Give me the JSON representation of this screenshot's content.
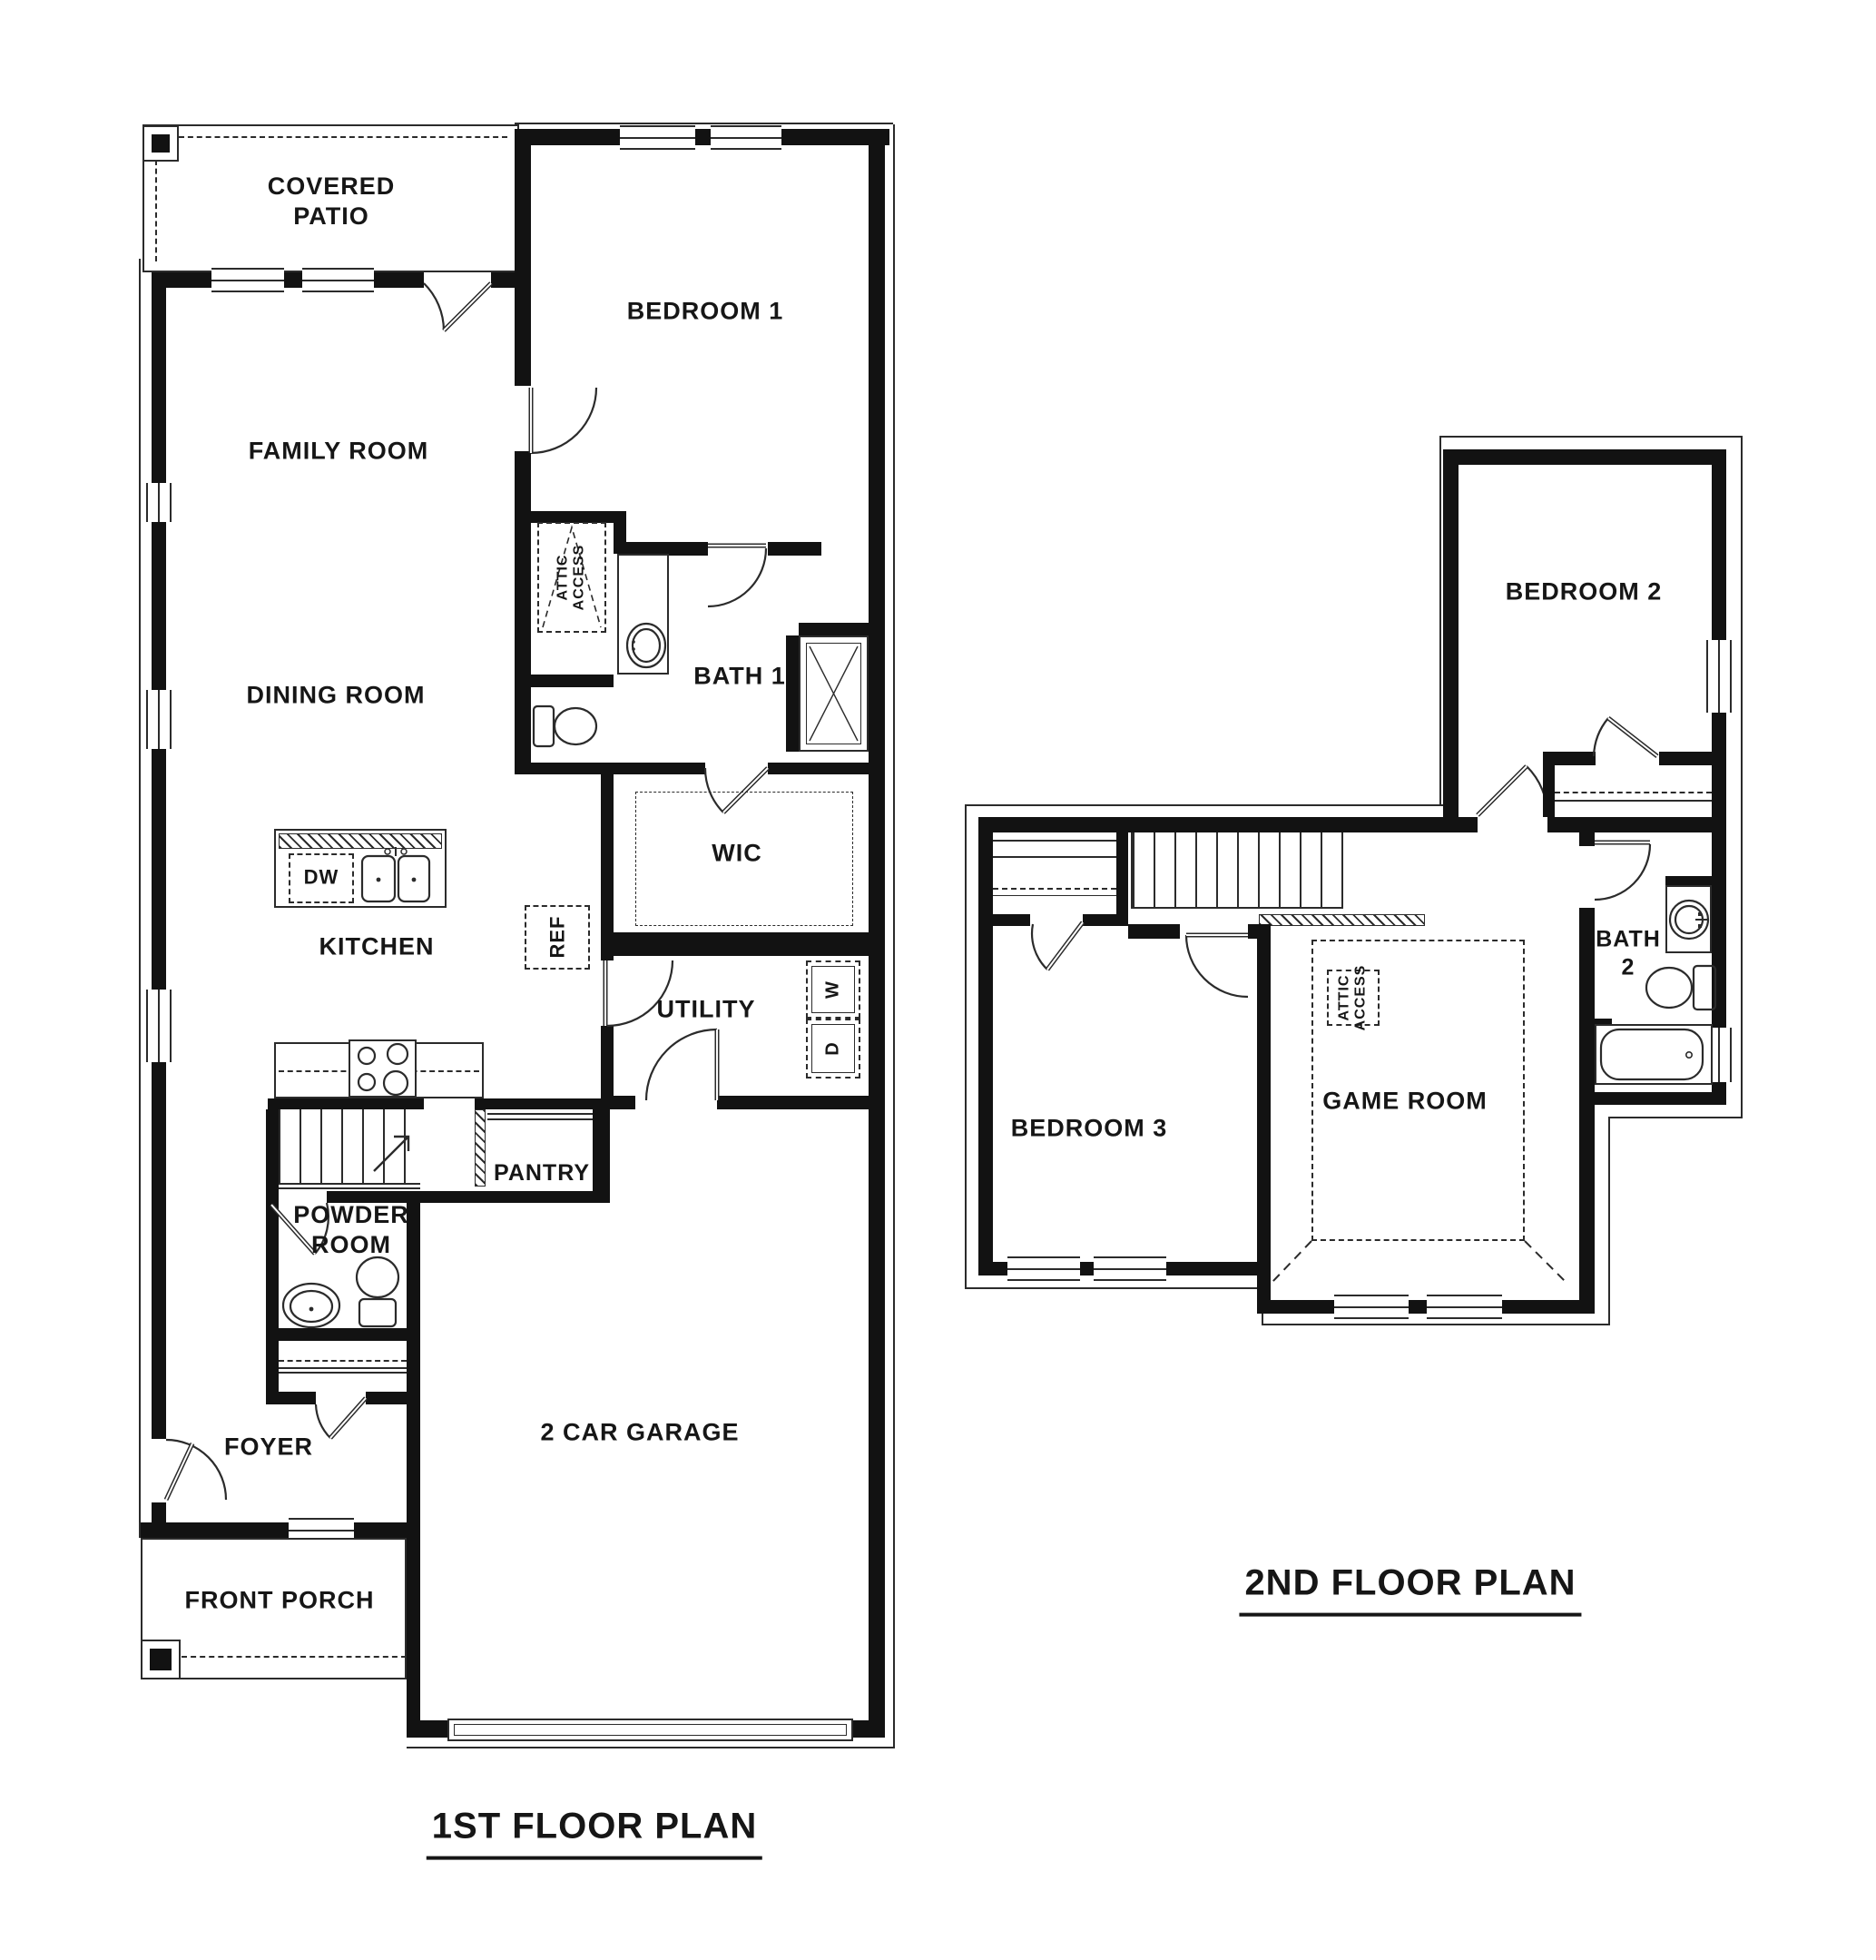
{
  "drawing": {
    "type": "residential floor plan, black line architectural drawing on white",
    "line_color": "#2b2b2b",
    "wall_color": "#121212"
  },
  "first_floor": {
    "title": "1ST FLOOR PLAN",
    "rooms": {
      "covered_patio": "COVERED\nPATIO",
      "family_room": "FAMILY ROOM",
      "dining_room": "DINING ROOM",
      "bedroom1": "BEDROOM 1",
      "bath1": "BATH 1",
      "wic": "WIC",
      "kitchen": "KITCHEN",
      "utility": "UTILITY",
      "pantry": "PANTRY",
      "powder_room": "POWDER\nROOM",
      "foyer": "FOYER",
      "front_porch": "FRONT PORCH",
      "garage": "2 CAR GARAGE"
    },
    "fixtures": {
      "attic_access": "ATTIC\nACCESS",
      "ref": "REF",
      "dw": "DW",
      "washer": "W",
      "dryer": "D"
    }
  },
  "second_floor": {
    "title": "2ND FLOOR PLAN",
    "rooms": {
      "bedroom2": "BEDROOM 2",
      "bedroom3": "BEDROOM 3",
      "game_room": "GAME ROOM",
      "bath2": "BATH\n2"
    },
    "fixtures": {
      "attic_access": "ATTIC\nACCESS"
    }
  }
}
